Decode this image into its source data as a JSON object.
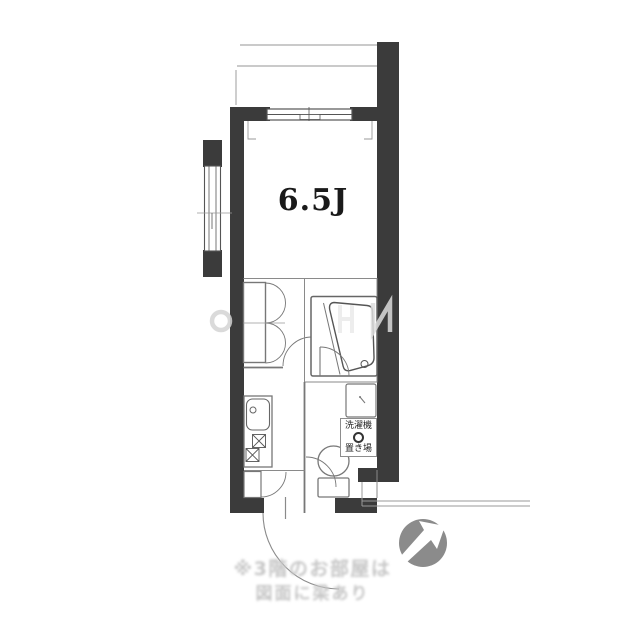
{
  "floorplan": {
    "room_label": "6.5J",
    "laundry": {
      "line1": "洗濯機",
      "line2": "置き場"
    },
    "caption": {
      "line1": "※3階のお部屋は",
      "line2": "図面に梁あり"
    },
    "fixtures": [
      "balcony",
      "sliding-window",
      "side-window",
      "closet",
      "bathtub",
      "washbasin",
      "toilet",
      "kitchen-sink",
      "gas-stove",
      "washing-machine-space",
      "entrance-door",
      "compass"
    ],
    "colors": {
      "wall": "#3b3b3b",
      "line_dark": "#555555",
      "line_mid": "#808080",
      "line_light": "#b8b8b8",
      "caption_text": "#c6c6c6",
      "compass": "#8b8b8b"
    }
  }
}
